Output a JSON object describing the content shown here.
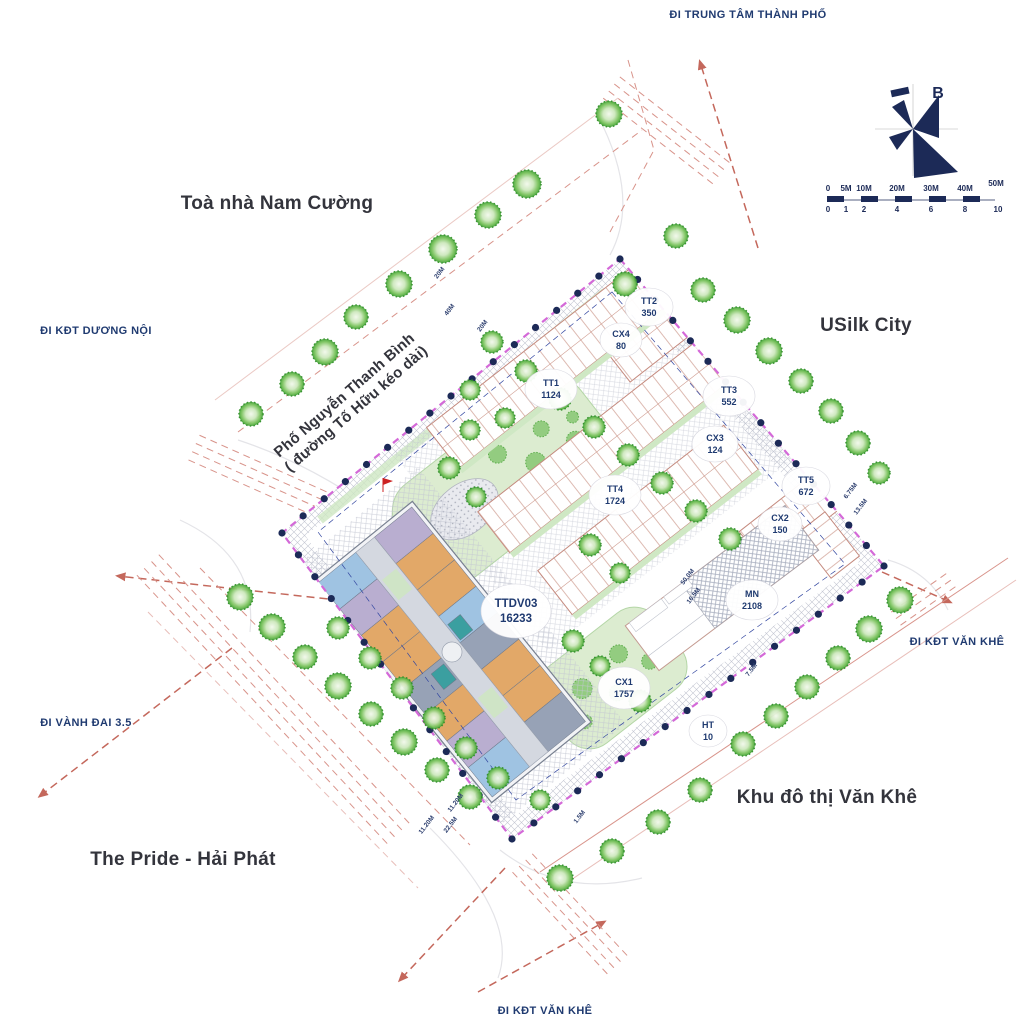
{
  "map": {
    "regions": [
      {
        "label": "Toà nhà Nam Cường"
      },
      {
        "label": "USilk City"
      },
      {
        "label": "Khu đô thị Văn Khê"
      },
      {
        "label": "The Pride - Hải Phát"
      }
    ],
    "roads": [
      {
        "label": "ĐI TRUNG TÂM THÀNH PHỐ"
      },
      {
        "label": "ĐI KĐT DƯƠNG NỘI"
      },
      {
        "label": "ĐI VÀNH ĐAI 3.5"
      },
      {
        "label": "ĐI KĐT VĂN KHÊ"
      },
      {
        "label": "ĐI KĐT VĂN KHÊ"
      }
    ],
    "street": {
      "line1": "Phố Nguyễn Thanh Bình",
      "line2": "( đường Tố Hữu kéo dài)"
    },
    "compass": {
      "label": "B"
    },
    "scalebar": {
      "top": [
        "0",
        "5M",
        "10M",
        "20M",
        "30M",
        "40M",
        "50M"
      ],
      "bottom": [
        "0",
        "1",
        "2",
        "4",
        "6",
        "8",
        "10"
      ]
    },
    "zones": [
      {
        "code": "TT2",
        "value": "350"
      },
      {
        "code": "CX4",
        "value": "80"
      },
      {
        "code": "TT1",
        "value": "1124"
      },
      {
        "code": "TT3",
        "value": "552"
      },
      {
        "code": "CX3",
        "value": "124"
      },
      {
        "code": "TT5",
        "value": "672"
      },
      {
        "code": "TT4",
        "value": "1724"
      },
      {
        "code": "CX2",
        "value": "150"
      },
      {
        "code": "MN",
        "value": "2108"
      },
      {
        "code": "TTDV03",
        "value": "16233"
      },
      {
        "code": "CX1",
        "value": "1757"
      },
      {
        "code": "HT",
        "value": "10"
      }
    ],
    "dims": [
      "20M",
      "40M",
      "20M",
      "11.20M",
      "22.5M",
      "11.20M",
      "1.5M",
      "7.5M",
      "6.75M",
      "13.5M",
      "50.0M",
      "16.5M"
    ],
    "colors": {
      "boundary_magenta": "#c93fd0",
      "marker_navy": "#1c2a57",
      "road_red": "#c4685c",
      "tree_green": "#44a437",
      "text_navy": "#1f3a70",
      "text_dark": "#33343c"
    }
  }
}
